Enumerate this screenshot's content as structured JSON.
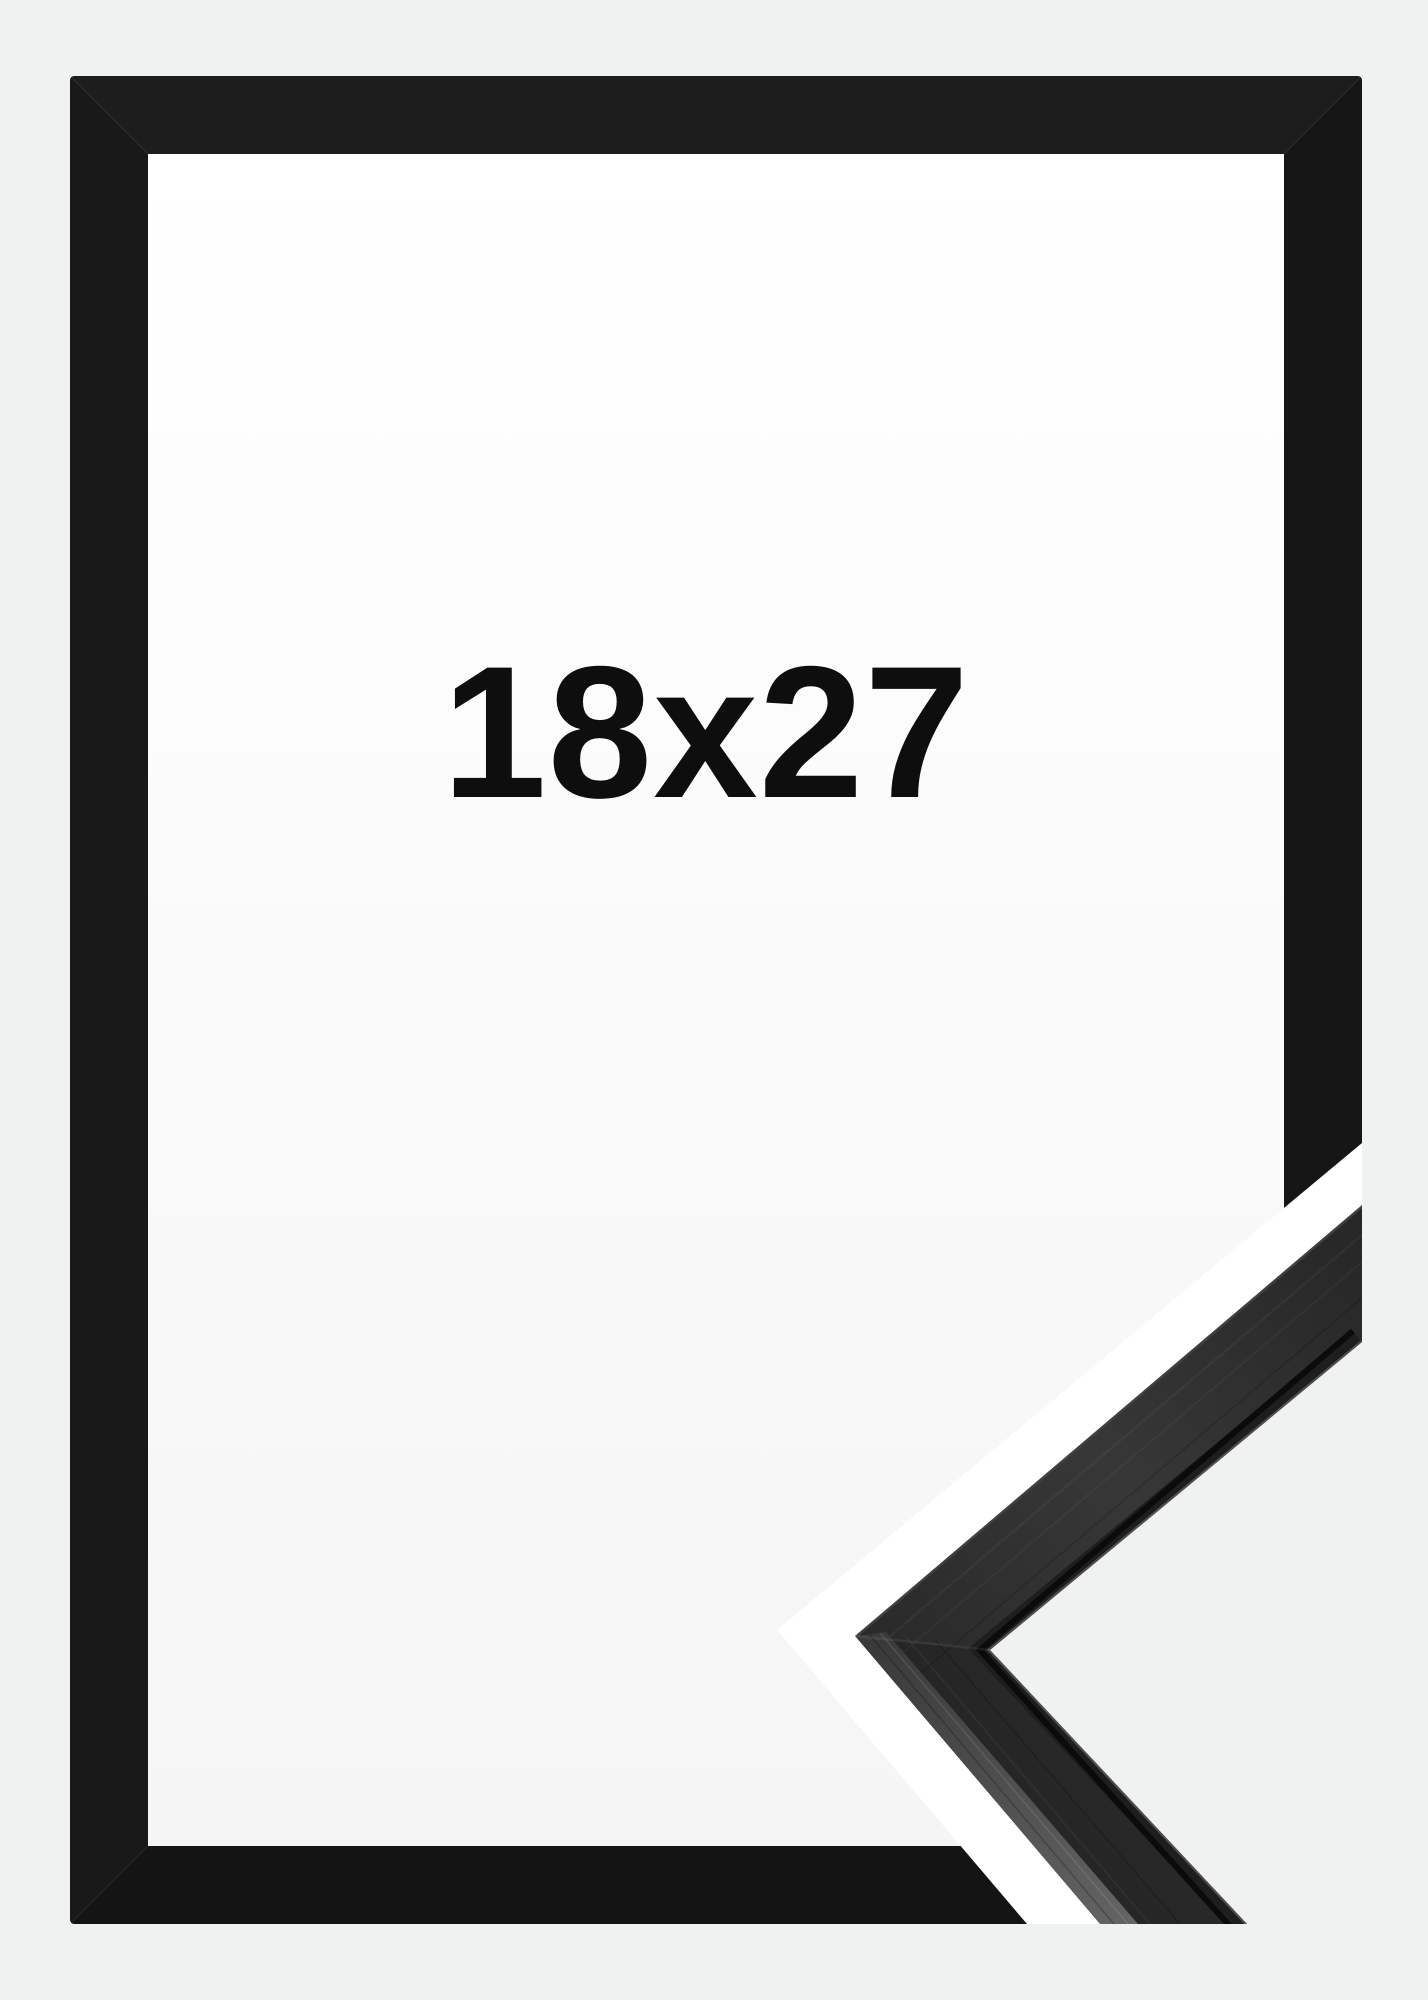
{
  "product": {
    "size_label": "18x27"
  },
  "colors": {
    "page_bg": "#f0f1f1",
    "frame_black": "#181818",
    "opening_top": "#ffffff",
    "opening_bottom": "#f5f5f5",
    "label_color": "#0e0e0e",
    "separator_white": "#ffffff",
    "closeup_bg": "#f0f1f1",
    "moulding_groove": "#0b0b0b"
  }
}
